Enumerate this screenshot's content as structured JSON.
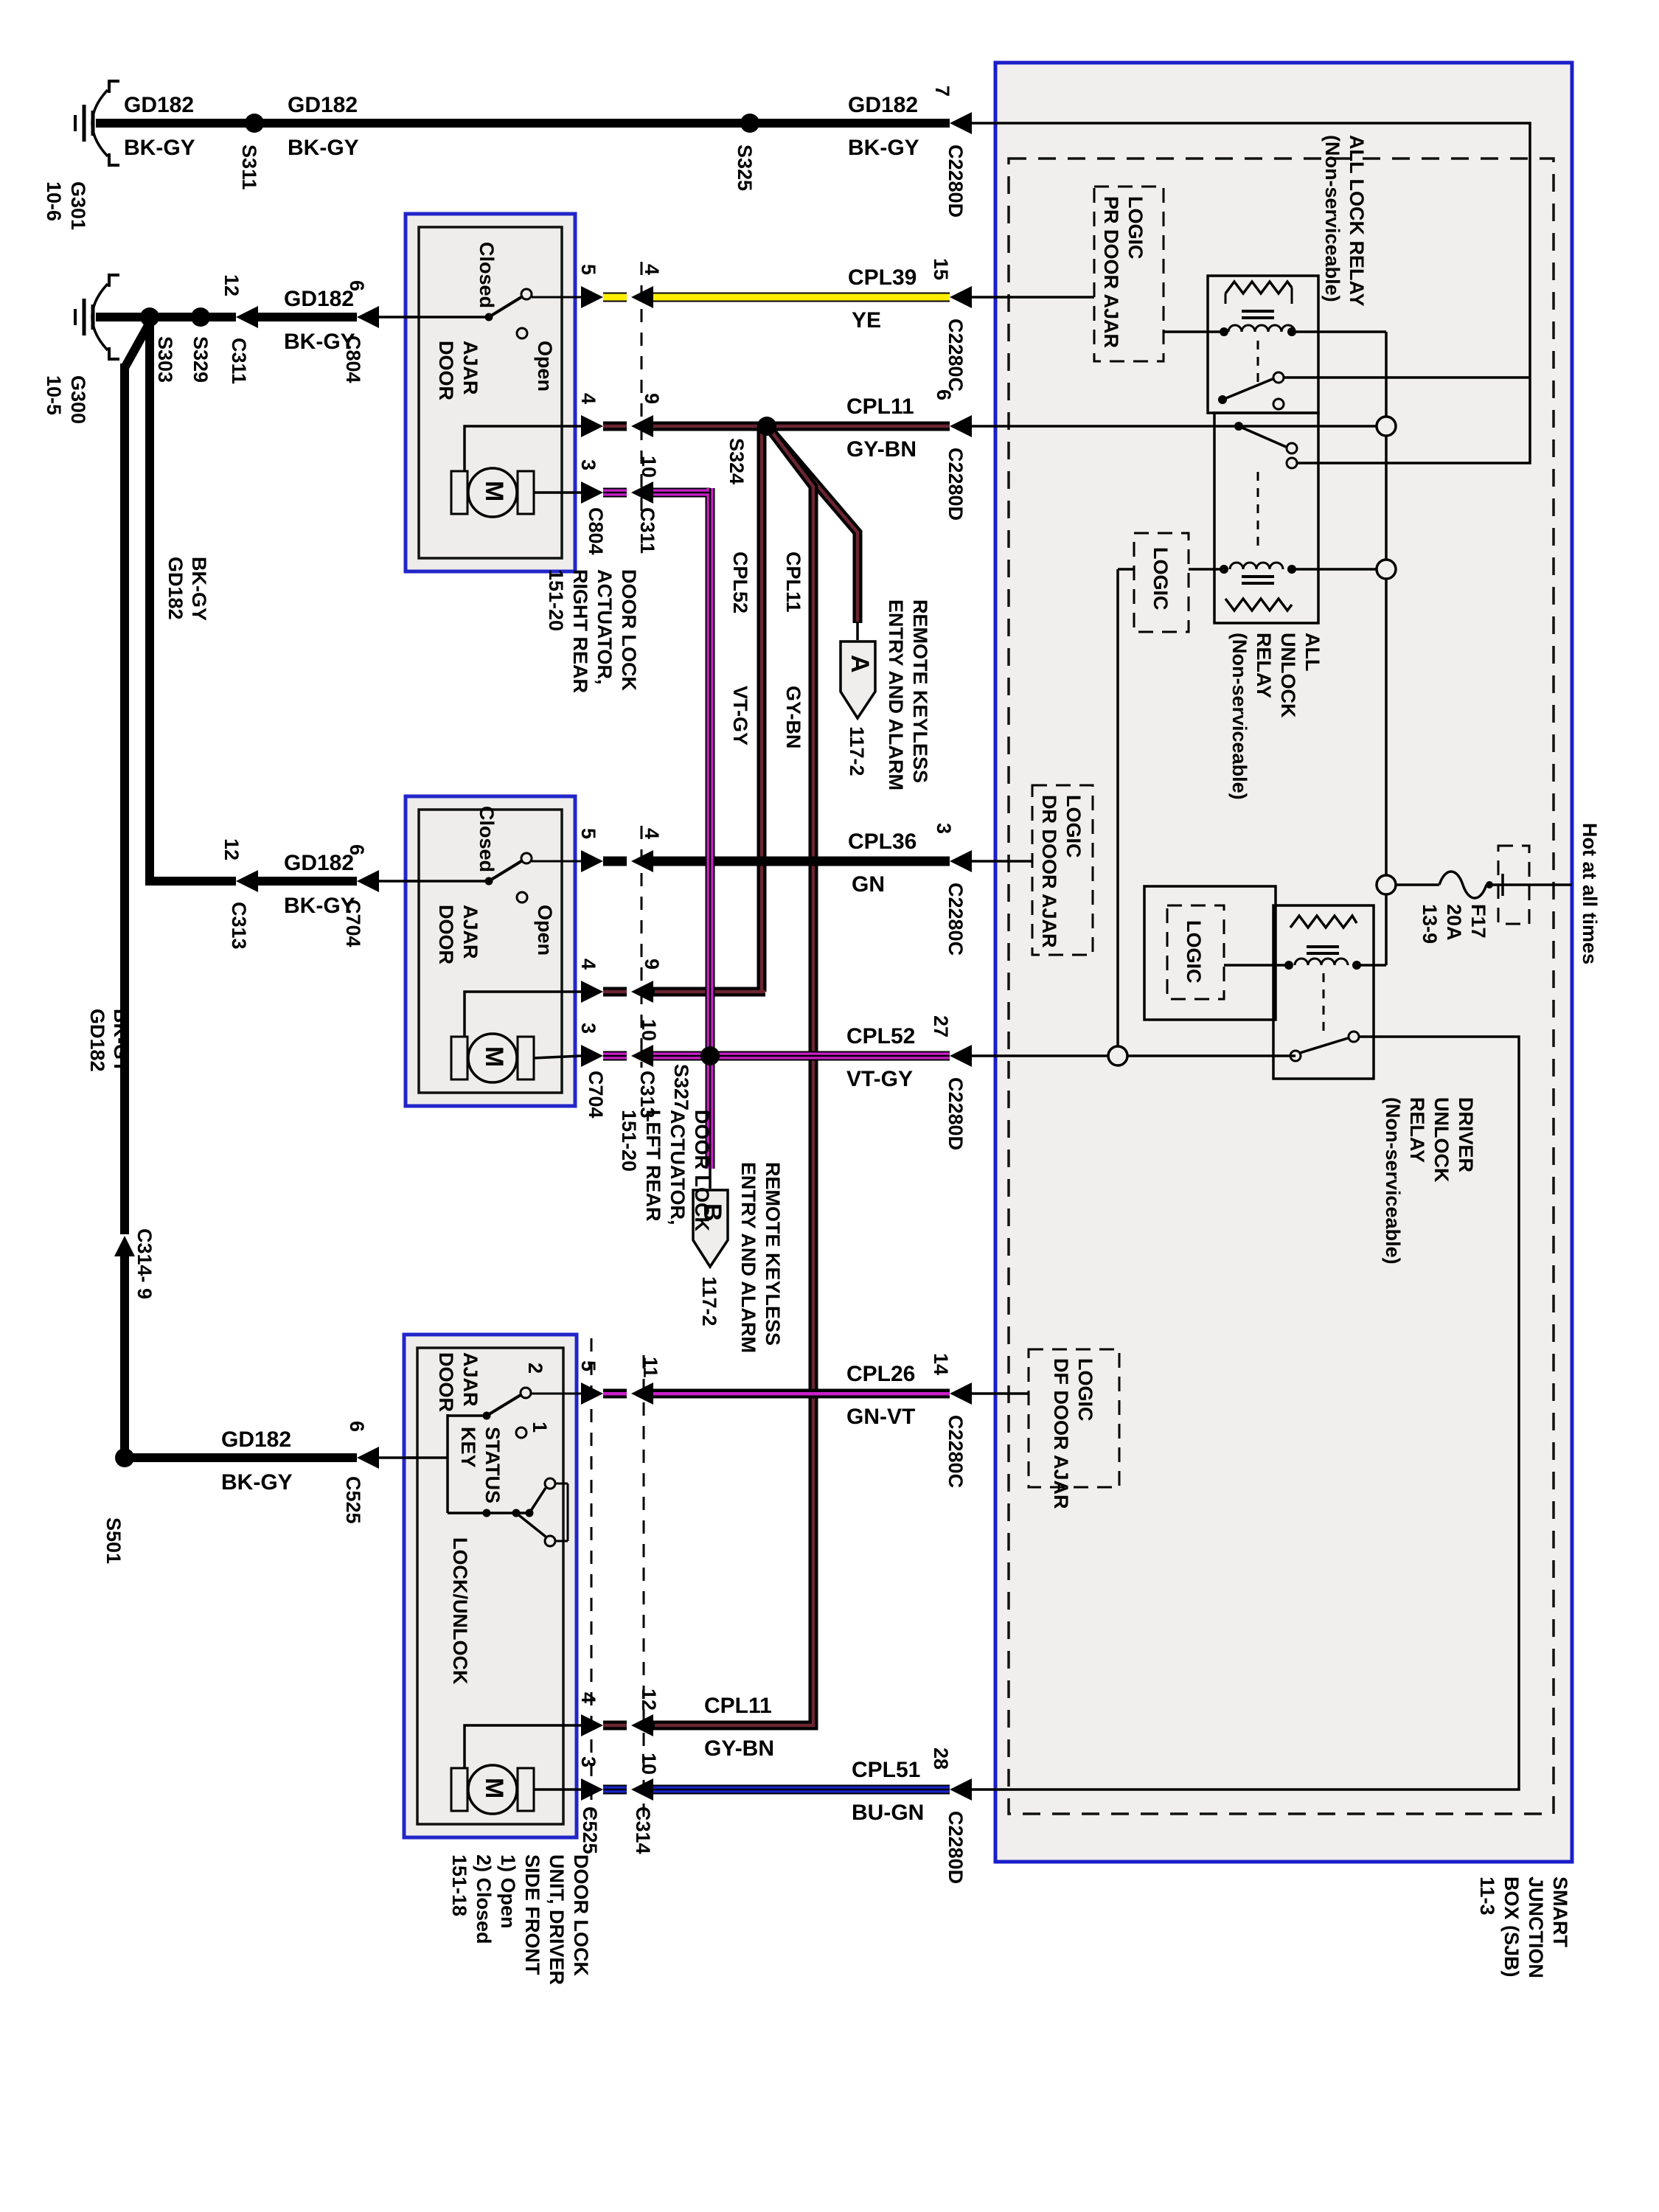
{
  "wires": {
    "gd182": {
      "label": "GD182",
      "color": "BK-GY"
    },
    "cpl39": {
      "label": "CPL39",
      "color": "YE"
    },
    "cpl11": {
      "label": "CPL11",
      "color": "GY-BN"
    },
    "cpl36": {
      "label": "CPL36",
      "color": "GN"
    },
    "cpl52": {
      "label": "CPL52",
      "color": "VT-GY"
    },
    "cpl26": {
      "label": "CPL26",
      "color": "GN-VT"
    },
    "cpl51": {
      "label": "CPL51",
      "color": "BU-GN"
    }
  },
  "grounds": {
    "g301": {
      "name": "G301",
      "page": "10-6"
    },
    "g300": {
      "name": "G300",
      "page": "10-5"
    }
  },
  "splices": {
    "s311": "S311",
    "s325": "S325",
    "s303": "S303",
    "s329": "S329",
    "s324": "S324",
    "s327": "S327",
    "s501": "S501"
  },
  "connectors": {
    "c2280d": "C2280D",
    "c2280c": "C2280C",
    "c311": "C311",
    "c804": "C804",
    "c313": "C313",
    "c704": "C704",
    "c525": "C525",
    "c314": "C314",
    "c314_break": "C314- 9"
  },
  "pins": {
    "1": "1",
    "2": "2",
    "3": "3",
    "4": "4",
    "5": "5",
    "6": "6",
    "7": "7",
    "9": "9",
    "10": "10",
    "11": "11",
    "12": "12",
    "14": "14",
    "15": "15",
    "27": "27",
    "28": "28"
  },
  "components": {
    "switch": {
      "closed": "Closed",
      "open": "Open",
      "door_ajar": [
        "DOOR",
        "AJAR"
      ],
      "motor": "M"
    },
    "actuator_right_rear": {
      "name_lines": [
        "DOOR LOCK",
        "ACTUATOR,",
        "RIGHT REAR",
        "151-20"
      ]
    },
    "actuator_left_rear": {
      "name_lines": [
        "DOOR LOCK",
        "ACTUATOR,",
        "LEFT REAR",
        "151-20"
      ]
    },
    "door_lock_unit": {
      "name_lines": [
        "DOOR LOCK",
        "UNIT, DRIVER",
        "SIDE FRONT",
        "1) Open",
        "2) Closed",
        "151-18"
      ],
      "key_status": [
        "KEY",
        "STATUS"
      ],
      "lock_unlock": "LOCK/UNLOCK"
    },
    "rke": {
      "name_lines": [
        "REMOTE KEYLESS",
        "ENTRY AND ALARM"
      ],
      "page": "117-2",
      "arrow_a": "A",
      "arrow_b": "B"
    }
  },
  "sjb": {
    "name_lines": [
      "SMART",
      "JUNCTION",
      "BOX (SJB)",
      "11-3"
    ],
    "hot": "Hot at all times",
    "fuse_lines": [
      "F17",
      "20A",
      "13-9"
    ],
    "logic": "LOGIC",
    "logic_pr": [
      "LOGIC",
      "PR DOOR AJAR"
    ],
    "logic_dr": [
      "LOGIC",
      "DR DOOR AJAR"
    ],
    "logic_df": [
      "LOGIC",
      "DF DOOR AJAR"
    ],
    "all_lock_lines": [
      "ALL LOCK RELAY",
      "(Non-serviceable)"
    ],
    "all_unlock_lines": [
      "ALL",
      "UNLOCK",
      "RELAY",
      "(Non-serviceable)"
    ],
    "driver_unlock_lines": [
      "DRIVER",
      "UNLOCK",
      "RELAY",
      "(Non-serviceable)"
    ]
  }
}
